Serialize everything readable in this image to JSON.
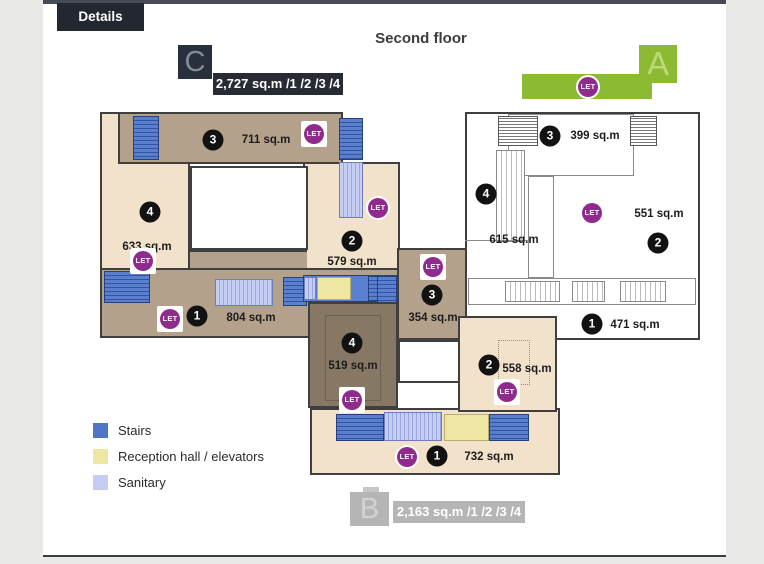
{
  "header": {
    "details_tab": "Details",
    "floor_title": "Second floor"
  },
  "buildings": {
    "c": {
      "letter": "C",
      "badge_label": "2,727 sq.m /1 /2 /3 /4"
    },
    "a": {
      "letter": "A"
    },
    "b": {
      "letter": "B",
      "badge_label": "2,163 sq.m /1 /2 /3 /4"
    }
  },
  "labels": {
    "let": "LET"
  },
  "rooms": {
    "c3": {
      "number": "3",
      "area": "711 sq.m"
    },
    "c4": {
      "number": "4",
      "area": "633 sq.m"
    },
    "c2": {
      "number": "2",
      "area": "579 sq.m"
    },
    "c1": {
      "number": "1",
      "area": "804 sq.m"
    },
    "b3": {
      "number": "3",
      "area": "354 sq.m"
    },
    "b4": {
      "number": "4",
      "area": "519 sq.m"
    },
    "b2": {
      "number": "2",
      "area": "558 sq.m"
    },
    "b1": {
      "number": "1",
      "area": "732 sq.m"
    },
    "a3": {
      "number": "3",
      "area": "399 sq.m"
    },
    "a4": {
      "number": "4",
      "area": "615 sq.m"
    },
    "a2": {
      "number": "2",
      "area": "551 sq.m"
    },
    "a1": {
      "number": "1",
      "area": "471 sq.m"
    }
  },
  "legend": {
    "items": [
      {
        "label": "Stairs",
        "color": "#4f75c4"
      },
      {
        "label": "Reception hall / elevators",
        "color": "#eee7a3"
      },
      {
        "label": "Sanitary",
        "color": "#c5cef2"
      }
    ]
  },
  "colors": {
    "let_purple": "#8e2b8d",
    "building_a_green": "#8cba32",
    "building_c_dark": "#262b34",
    "building_b_gray": "#b5b5b5",
    "room_medium_tan": "#b3a18c",
    "room_light_tan": "#f2e2cb",
    "room_dark_brown": "#877866"
  }
}
